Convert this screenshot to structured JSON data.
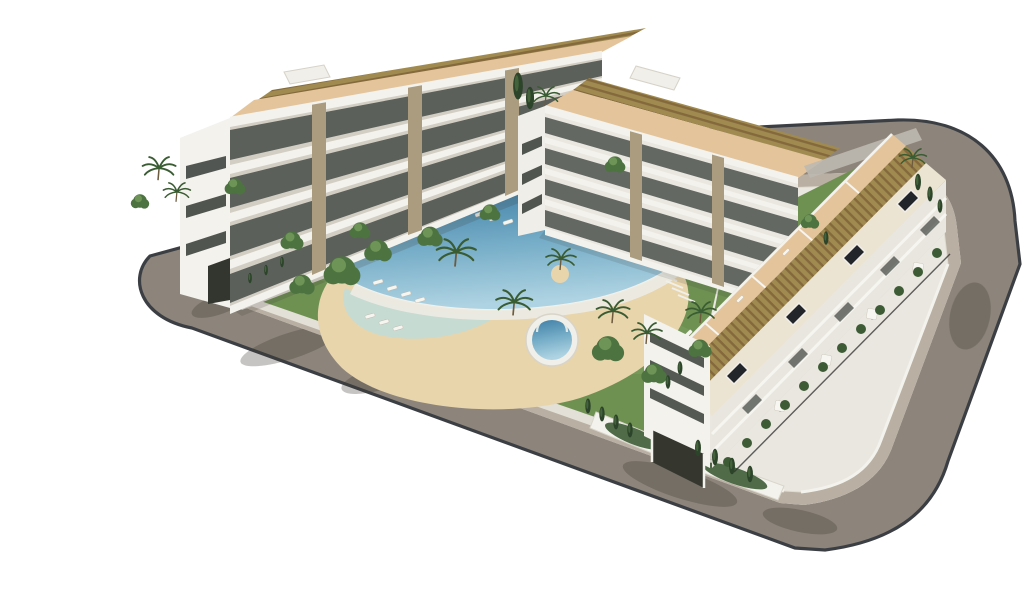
{
  "meta": {
    "title": "Aerial 3D architectural render of a new-build apartment complex with communal pool, gardens and perimeter ring road",
    "scene_type": "architectural-visualization",
    "objects": [
      "perimeter-ring-road",
      "sidewalk",
      "building-plot",
      "apartment-building-left",
      "apartment-building-back",
      "apartment-building-right",
      "central-garden",
      "main-curved-pool",
      "kids-round-pool",
      "ornamental-pond",
      "padel-courts",
      "sun-loungers",
      "parasols",
      "palm-trees",
      "cypress-trees",
      "rooftop-pergolas",
      "roof-terraces",
      "skylights",
      "garage-entrance",
      "hedges",
      "tree-shadows"
    ]
  },
  "colors": {
    "bg": "#ffffff",
    "asphalt": "#8d857b",
    "curb": "#3b3f44",
    "sidewalk": "#b9afa2",
    "plot": "#eae7e0",
    "grass": "#6e9152",
    "grass_light": "#8fae6e",
    "sand": "#e8d5ac",
    "lagoon": "#c2dcd6",
    "pool_deep": "#3f7fa6",
    "pool_mid": "#79afc9",
    "pool_light": "#aed3e2",
    "pool_wall": "#ecebe3",
    "building_white": "#f3f2ed",
    "building_shade": "#d2cec4",
    "window_dark": "#3f4540",
    "stone": "#ab9c80",
    "terrace": "#e4c49b",
    "pergola": "#a18a50",
    "pergola_dark": "#83693c",
    "court_blue": "#5d7dc1",
    "court_line": "#dfe6f4",
    "tree_mid": "#4d7340",
    "tree_light": "#6e9457",
    "cypress": "#2c4429",
    "hedge": "#3d5c36",
    "trunk": "#6d5b3e",
    "fence": "#2e2e2c",
    "skylight": "#22262a",
    "shadow_color": "#3c3a33",
    "roof_cream": "#ece4d2",
    "roof_pool": "#cfe3e8",
    "wall_grey": "#bdb9b0"
  }
}
